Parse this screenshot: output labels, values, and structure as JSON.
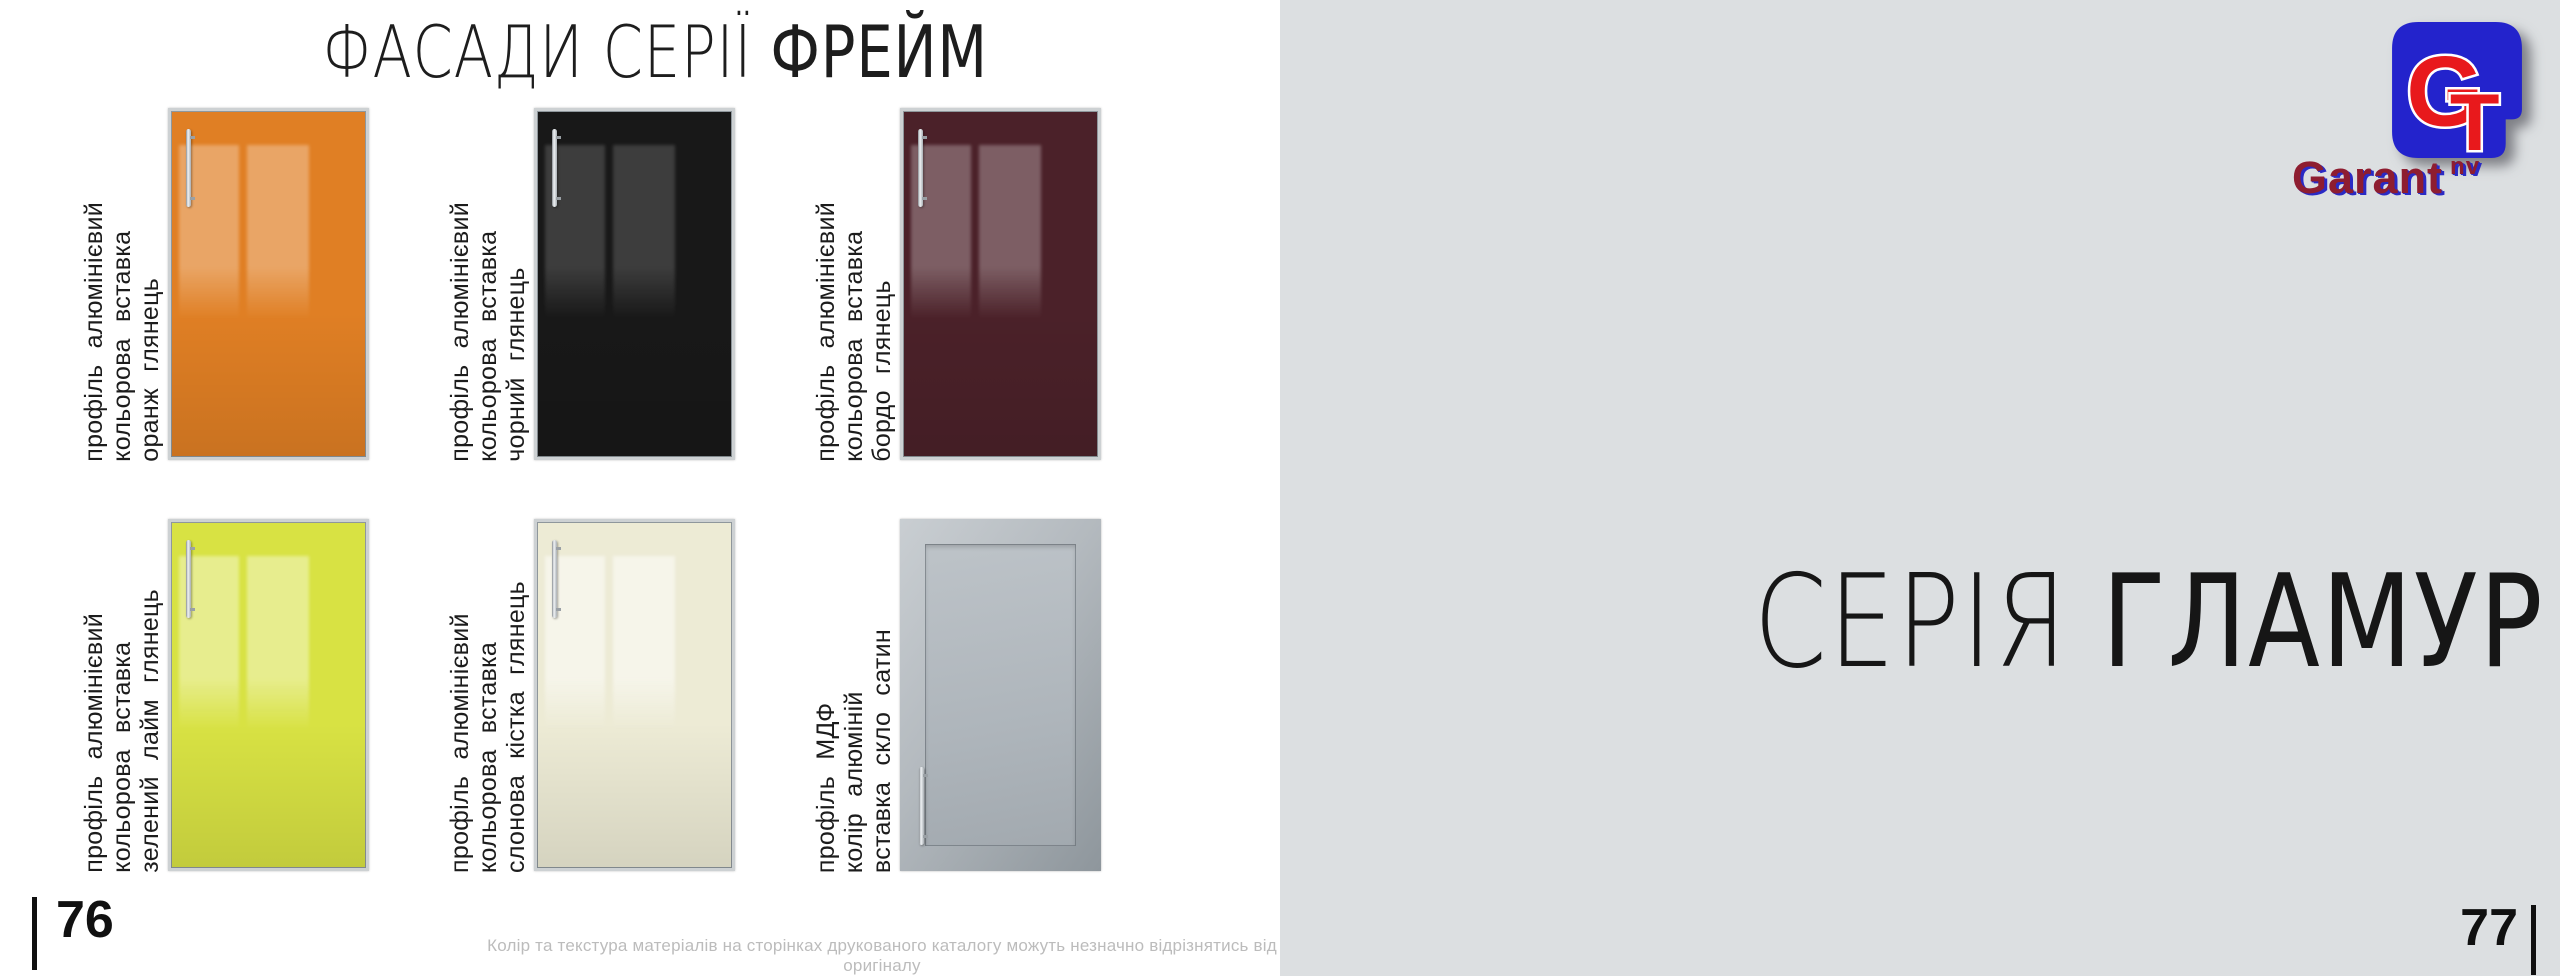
{
  "left_page": {
    "title": {
      "thin": "ФАСАДИ СЕРІЇ",
      "strong": "ФРЕЙМ"
    },
    "facades": [
      {
        "name": "orange-gloss",
        "lines": [
          "профіль  алюмінієвий",
          "кольорова  вставка",
          "оранж  глянець"
        ],
        "face_color": "#e07f24",
        "sheen_color": "rgba(255,255,255,0.30)",
        "frame": "aluminum-frame",
        "handle": "top"
      },
      {
        "name": "black-gloss",
        "lines": [
          "профіль  алюмінієвий",
          "кольорова  вставка",
          "чорний  глянець"
        ],
        "face_color": "#181818",
        "sheen_color": "rgba(255,255,255,0.16)",
        "frame": "aluminum-frame",
        "handle": "top"
      },
      {
        "name": "bordeaux-gloss",
        "lines": [
          "профіль  алюмінієвий",
          "кольорова  вставка",
          "бордо  глянець"
        ],
        "face_color": "#4b2129",
        "sheen_color": "rgba(255,255,255,0.28)",
        "frame": "aluminum-frame",
        "handle": "top"
      },
      {
        "name": "lime-green-gloss",
        "lines": [
          "профіль  алюмінієвий",
          "кольорова  вставка",
          "зелений  лайм  глянець"
        ],
        "face_color": "#d8e243",
        "sheen_color": "rgba(255,255,255,0.40)",
        "frame": "aluminum-frame",
        "handle": "top"
      },
      {
        "name": "ivory-gloss",
        "lines": [
          "профіль  алюмінієвий",
          "кольорова  вставка",
          "слонова  кістка  глянець"
        ],
        "face_color": "#edebd5",
        "sheen_color": "rgba(255,255,255,0.50)",
        "frame": "aluminum-frame",
        "handle": "top"
      },
      {
        "name": "satin-glass-mdf",
        "lines": [
          "профіль  МДФ",
          "колір  алюміній",
          "вставка  скло  сатин"
        ],
        "face_color": "#b3b9be",
        "sheen_color": "rgba(255,255,255,0.25)",
        "frame": "mdf-frame",
        "handle": "bottom"
      }
    ],
    "page_number": "76",
    "disclaimer": "Колір та текстура матеріалів на сторінках друкованого каталогу можуть незначно відрізнятись від оригіналу"
  },
  "right_page": {
    "title": {
      "thin": "СЕРІЯ",
      "strong": "ГЛАМУР"
    },
    "page_number": "77",
    "background_color": "#dcdfe1",
    "logo": {
      "monogram_g": "G",
      "monogram_t": "T",
      "brand": "Garant",
      "suffix": "nv",
      "square_color": "#2323cc",
      "letter_color": "#e8191c",
      "brand_color": "#8e1d30",
      "shadow_color": "#2a2ac4"
    }
  }
}
